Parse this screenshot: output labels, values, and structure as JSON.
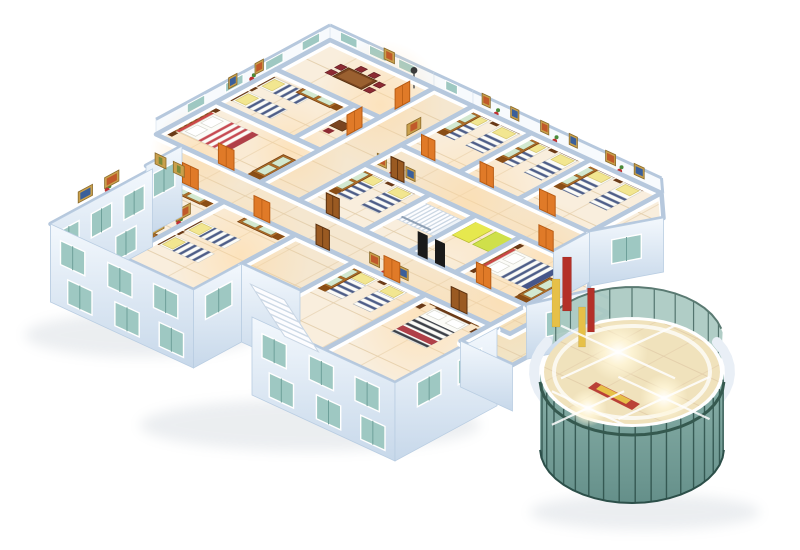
{
  "scene": {
    "type": "3d-isometric-floor-plan-cutaway",
    "description": "Bird's-eye dollhouse rendering of a residential floor: bedrooms with striped beds, corridors, dining room, staircases and a curved glass atrium",
    "background": "#ffffff"
  },
  "colors": {
    "wall_cap": "#b6c8dd",
    "far_band": "#f7fafd",
    "floor_room": "#f9eedd",
    "floor_corridor": "#f5e7d0",
    "floor_connector": "#f1e4c6",
    "floor_line": "#e2cda9",
    "floor_glow": "#ffd9a2",
    "ext_wall_hi": "#f3f8fd",
    "ext_wall_lo": "#c7d8ea",
    "window_glass": "#9ec8c2",
    "window_frame": "#ffffff",
    "window_mullion": "#6ea09a",
    "door_orange": "#e07a28",
    "door_orange_dark": "#b85c14",
    "door_wood": "#9a5a22",
    "wood_dark": "#6a3a18",
    "wardrobe_body": "#b06c28",
    "wardrobe_side": "#8a4e16",
    "wardrobe_panel": "#d2e8d0",
    "headboard_wood": "#8a5026",
    "headboard_check": "#c89858",
    "headboard_cream": "#f6ecc2",
    "headboard_red": "#cc4848",
    "stripe_navy": "#4e5e88",
    "stripe_red": "#c64a52",
    "stripe_dark": "#3c4048",
    "bed_white": "#fcfcf8",
    "pillow_yellow": "#f2e690",
    "chair_red": "#8c2a32",
    "table_wood": "#7a4520",
    "stair_white": "#fdfdff",
    "stair_edge": "#c9d6e4",
    "mat_yellow": "#e6e84e",
    "mat_green": "#cfe04a",
    "black_panel": "#1a1a1a",
    "glass_light": "#a9c9c1",
    "glass_dark_hi": "#84ada5",
    "glass_dark_lo": "#5d8a84",
    "glass_frame": "#3c5f59",
    "rim_white": "#e9eff6",
    "column_red": "#b43028",
    "column_yellow": "#e6c048",
    "atrium_floor": "#f0e2bc",
    "flare": "#fff6d8",
    "art_gold": "#c9a04c",
    "art_red": "#c05a2a",
    "art_blue": "#3a5f9a",
    "art_green": "#7a8a3a",
    "shadow": "#8898a8"
  },
  "inventory": {
    "rooms": [
      "dining-room",
      "twin-bedroom-top",
      "study-nook",
      "master-bedroom-1",
      "upper-hall",
      "twin-bedroom-a",
      "twin-bedroom-b",
      "corner-twin-bedroom",
      "upper-corridor",
      "twin-bedroom-mid",
      "stair-room",
      "mat-room",
      "blue-double-bedroom",
      "main-corridor",
      "master-bedroom-2",
      "twin-bedroom-left",
      "entry-hall",
      "twin-bedroom-bottom",
      "master-bedroom-3",
      "atrium-connector",
      "glass-atrium"
    ],
    "single_beds": 14,
    "double_beds": 4,
    "wardrobes": 10,
    "dining_sets": 1,
    "interior_staircases": 1,
    "exterior_staircases": 1,
    "glass_atriums": 1,
    "yellow_mats": 2,
    "black_panels": 2,
    "light_flares": 3
  }
}
